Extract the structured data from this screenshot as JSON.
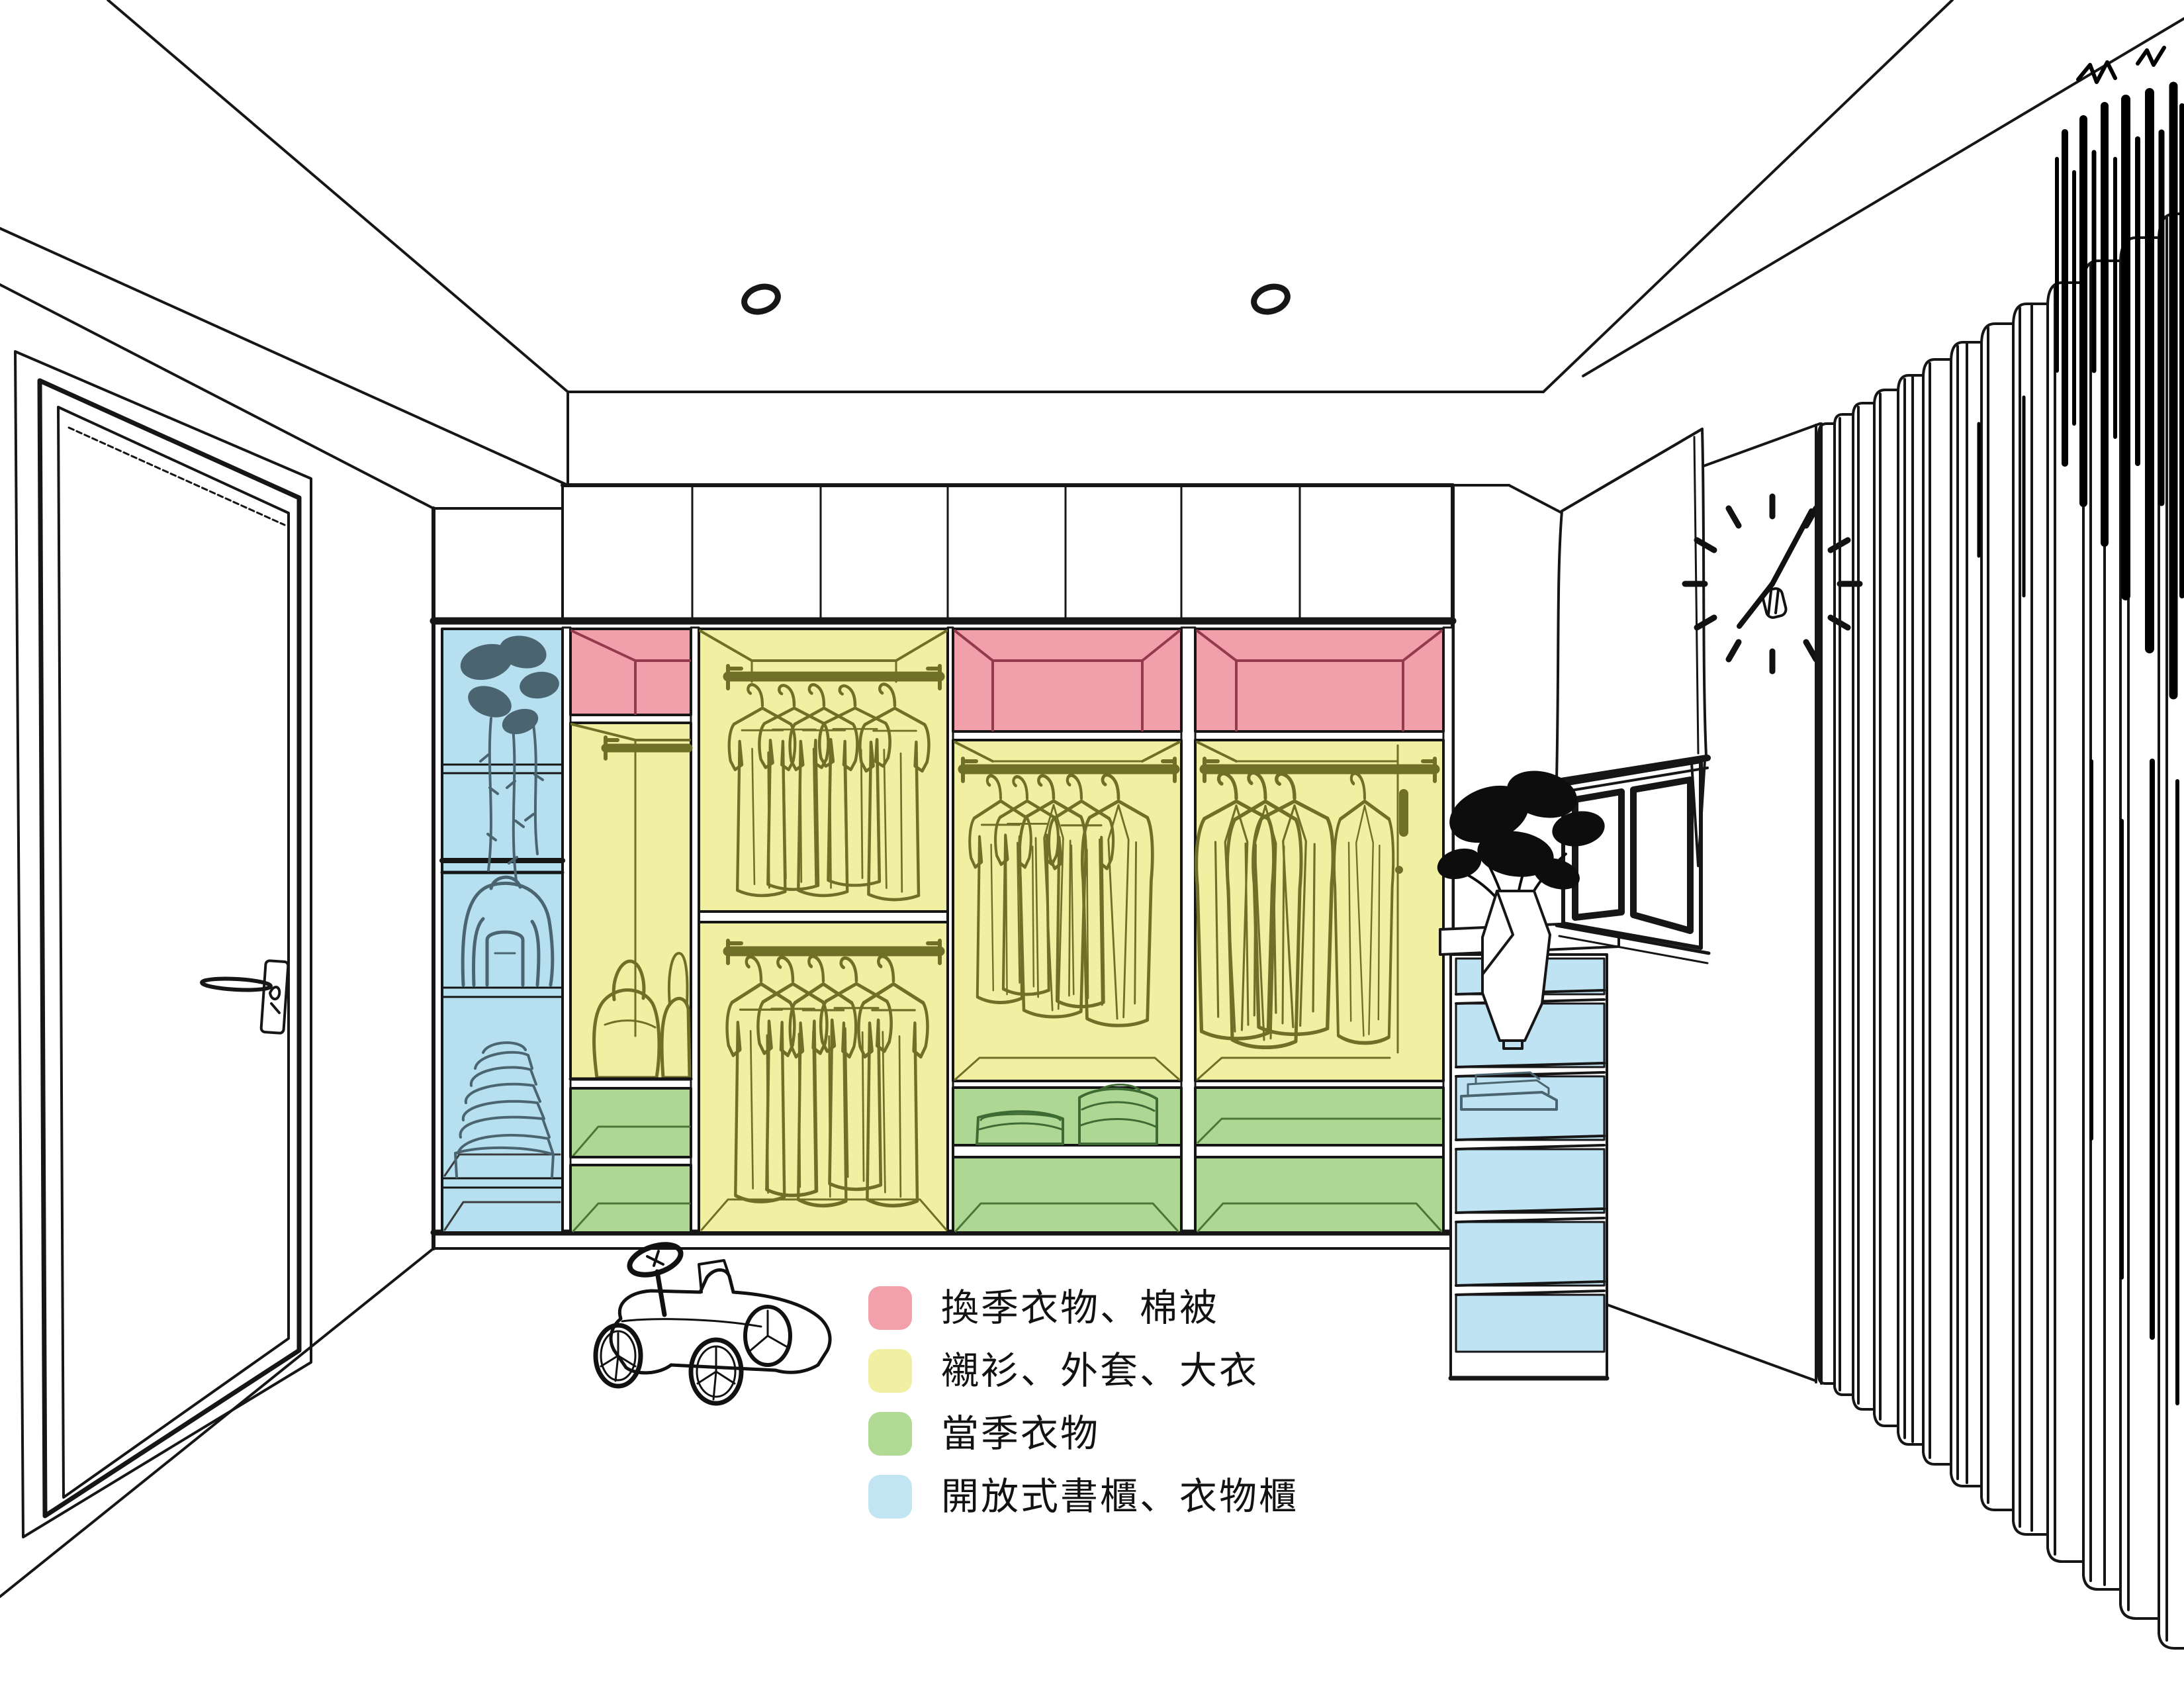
{
  "legend": {
    "items": [
      {
        "id": "seasonal-storage",
        "label": "換季衣物、棉被",
        "color": "#F2A1AC"
      },
      {
        "id": "shirts-coats",
        "label": "襯衫、外套、大衣",
        "color": "#F1EFA1"
      },
      {
        "id": "current-season",
        "label": "當季衣物",
        "color": "#B1DA95"
      },
      {
        "id": "open-shelving",
        "label": "開放式書櫃、衣物櫃",
        "color": "#C2E5F4"
      }
    ]
  },
  "zone_colors": {
    "pink": "#F1A0AB",
    "yellow": "#F0EFA2",
    "green": "#AFD794",
    "blue_bookcase": "#B6DFF0",
    "blue_cabinet": "#BFE3F2",
    "sketch_olive": "#6F6F28",
    "sketch_slate": "#4A6570",
    "sketch_green": "#3E6B33",
    "line": "#161616"
  },
  "wardrobe": {
    "columns": [
      {
        "name": "open-shelf-column",
        "zones": [
          "blue"
        ],
        "contents": [
          "hanging-plant",
          "backpack",
          "folded-clothes"
        ]
      },
      {
        "name": "small-hanging-column",
        "zones": [
          "pink",
          "yellow",
          "green"
        ],
        "contents": [
          "rod",
          "two-bags"
        ]
      },
      {
        "name": "double-rod-column",
        "zones": [
          "yellow"
        ],
        "contents": [
          "upper-rod-shirts",
          "lower-rod-shirts"
        ]
      },
      {
        "name": "hanging-column",
        "zones": [
          "pink",
          "yellow",
          "green"
        ],
        "contents": [
          "rod-jackets",
          "folded-stacks"
        ]
      },
      {
        "name": "hanging-column-with-door",
        "zones": [
          "pink",
          "yellow",
          "green"
        ],
        "contents": [
          "rod-coats",
          "door-handle"
        ]
      }
    ]
  },
  "side_cabinet": {
    "zone": "blue",
    "shelves": 6,
    "contents": [
      "towels"
    ],
    "top": [
      "vase-plant"
    ]
  },
  "room_objects": [
    "door",
    "ceiling-lights",
    "wall-clock",
    "window",
    "roman-shade",
    "curtain",
    "toy-car"
  ]
}
